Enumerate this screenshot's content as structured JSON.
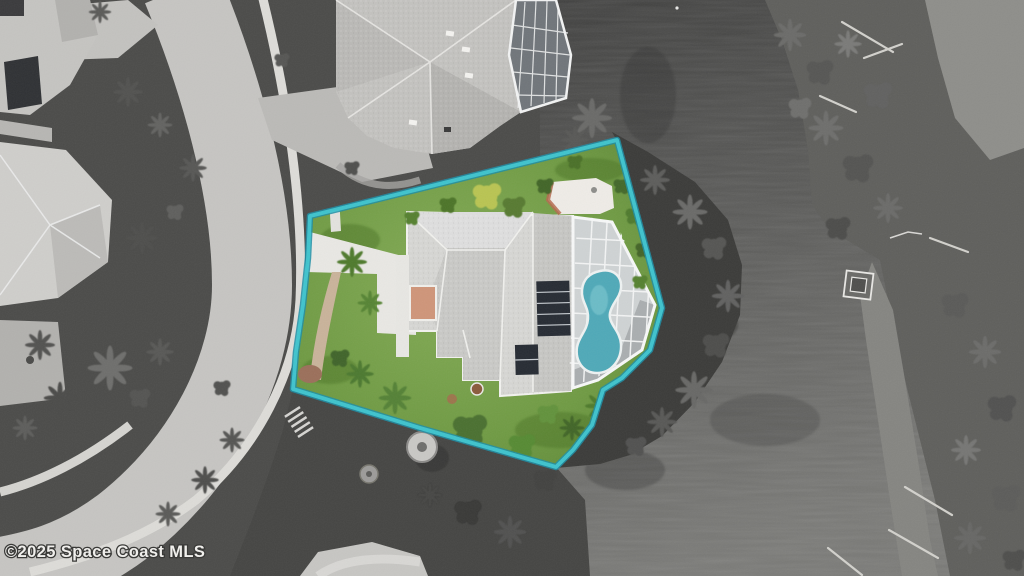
{
  "watermark": {
    "text": "©2025 Space Coast MLS"
  },
  "colors": {
    "boundary": "#40c6d0",
    "boundary_edge": "#1d8ea6",
    "pool_water": "#4fa9b8",
    "pool_highlight": "#8ed3da",
    "lawn_green": "#6f9a43",
    "solar_panel": "#262b33",
    "roof_gray": "#d6d6d3",
    "terracotta": "#cf9579",
    "canal_water": "#585856",
    "watermark_text": "#f0efec"
  }
}
